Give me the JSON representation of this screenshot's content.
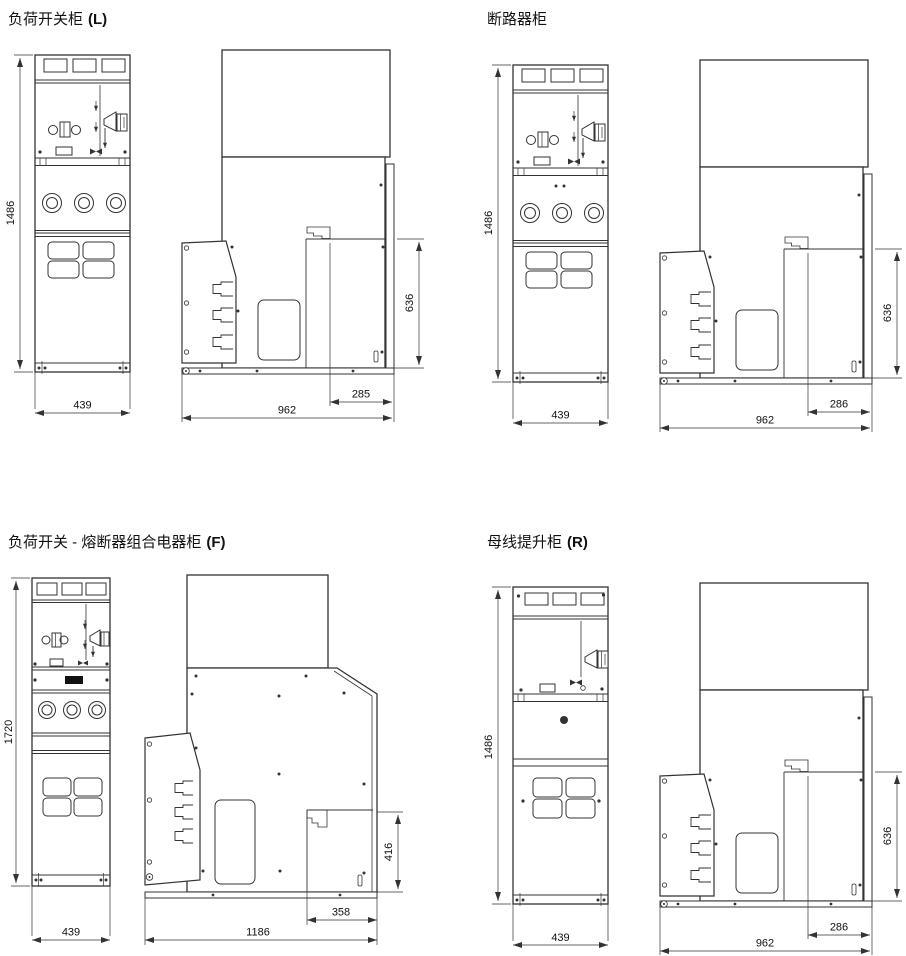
{
  "drawing": {
    "sheet_name": "switchgear-cabinet-dimension-drawings",
    "line_color": "#333333",
    "background": "#ffffff",
    "panels": [
      {
        "id": "load-switch-cabinet",
        "title": "负荷开关柜",
        "code": "(L)",
        "dims": {
          "overall_height": "1486",
          "front_width": "439",
          "depth": "962",
          "lower_rear_depth": "285",
          "rear_compartment_height": "636"
        }
      },
      {
        "id": "circuit-breaker-cabinet",
        "title": "断路器柜",
        "code": "",
        "dims": {
          "overall_height": "1486",
          "front_width": "439",
          "depth": "962",
          "lower_rear_depth": "286",
          "rear_compartment_height": "636"
        }
      },
      {
        "id": "switch-fuse-combination-cabinet",
        "title": "负荷开关 - 熔断器组合电器柜",
        "code": "(F)",
        "dims": {
          "overall_height": "1720",
          "front_width": "439",
          "depth": "1186",
          "lower_rear_depth": "358",
          "rear_compartment_height": "416"
        }
      },
      {
        "id": "busbar-riser-cabinet",
        "title": "母线提升柜",
        "code": "(R)",
        "dims": {
          "overall_height": "1486",
          "front_width": "439",
          "depth": "962",
          "lower_rear_depth": "286",
          "rear_compartment_height": "636"
        }
      }
    ]
  }
}
